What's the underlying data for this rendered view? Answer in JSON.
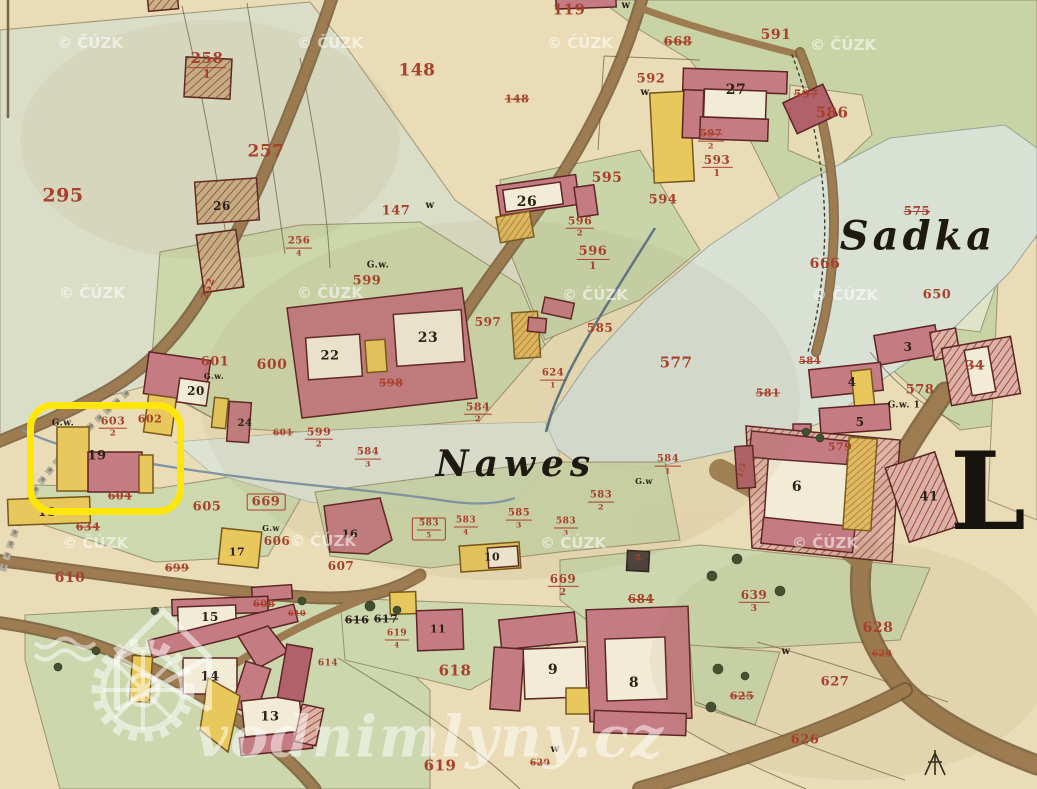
{
  "map": {
    "big_letter": "L",
    "logo_text": "vodnimlyny.cz",
    "palette": {
      "label_red": "#a8402c",
      "label_black": "#2b2217",
      "highlight_yellow": "#ffe60a",
      "building_pink": "#c47c82",
      "building_yellow": "#e8c85c",
      "road_brown": "#9c7c50",
      "field_green": "#c9d4a6",
      "pond_grey": "#d9e1d5",
      "paper": "#e9dcb6",
      "watermark_white": "rgba(255,255,255,0.55)"
    },
    "watermark": {
      "text": "© ČÚZK",
      "positions": [
        [
          90,
          43
        ],
        [
          330,
          43
        ],
        [
          580,
          43
        ],
        [
          843,
          45
        ],
        [
          92,
          293
        ],
        [
          330,
          293
        ],
        [
          595,
          295
        ],
        [
          845,
          295
        ],
        [
          95,
          543
        ],
        [
          323,
          541
        ],
        [
          573,
          543
        ],
        [
          825,
          543
        ]
      ]
    },
    "highlight": {
      "x": 27,
      "y": 402,
      "w": 143,
      "h": 99,
      "radius": 26,
      "color": "#ffe60a",
      "thickness": 7
    },
    "place_names": [
      {
        "text": "Sadka",
        "x": 918,
        "y": 236,
        "size": 40,
        "ls": 4
      },
      {
        "text": "Nawes",
        "x": 516,
        "y": 464,
        "size": 36,
        "ls": 6
      }
    ],
    "labels": [
      {
        "t": "295",
        "x": 63,
        "y": 196,
        "c": "r",
        "s": 19
      },
      {
        "t": "258",
        "d": "1",
        "x": 207,
        "y": 66,
        "c": "r",
        "s": 15
      },
      {
        "t": "257",
        "x": 266,
        "y": 152,
        "c": "r",
        "s": 17
      },
      {
        "t": "256",
        "d": "4",
        "x": 299,
        "y": 247,
        "c": "r",
        "s": 10
      },
      {
        "t": "252",
        "x": 209,
        "y": 289,
        "c": "r",
        "s": 10,
        "o": -70
      },
      {
        "t": "26",
        "x": 222,
        "y": 206,
        "c": "k",
        "s": 12
      },
      {
        "t": "119",
        "x": 569,
        "y": 10,
        "c": "r",
        "s": 15
      },
      {
        "t": "148",
        "x": 417,
        "y": 71,
        "c": "r",
        "s": 17
      },
      {
        "t": "148",
        "x": 517,
        "y": 99,
        "c": "r",
        "s": 11,
        "st": true
      },
      {
        "t": "147",
        "x": 396,
        "y": 211,
        "c": "r",
        "s": 13
      },
      {
        "t": "w",
        "x": 430,
        "y": 206,
        "c": "k",
        "s": 10
      },
      {
        "t": "w",
        "x": 626,
        "y": 6,
        "c": "k",
        "s": 10
      },
      {
        "t": "591",
        "x": 776,
        "y": 35,
        "c": "r",
        "s": 14
      },
      {
        "t": "592",
        "x": 651,
        "y": 79,
        "c": "r",
        "s": 13
      },
      {
        "t": "w",
        "x": 645,
        "y": 93,
        "c": "k",
        "s": 10
      },
      {
        "t": "668",
        "x": 678,
        "y": 42,
        "c": "r",
        "s": 13,
        "st": true
      },
      {
        "t": "27",
        "x": 736,
        "y": 90,
        "c": "k",
        "s": 14
      },
      {
        "t": "597",
        "x": 806,
        "y": 94,
        "c": "r",
        "s": 11,
        "st": true
      },
      {
        "t": "586",
        "x": 832,
        "y": 113,
        "c": "r",
        "s": 15
      },
      {
        "t": "597",
        "d": "2",
        "x": 711,
        "y": 140,
        "c": "r",
        "s": 10,
        "st": true
      },
      {
        "t": "593",
        "d": "1",
        "x": 717,
        "y": 166,
        "c": "r",
        "s": 12
      },
      {
        "t": "595",
        "x": 607,
        "y": 178,
        "c": "r",
        "s": 14
      },
      {
        "t": "594",
        "x": 663,
        "y": 200,
        "c": "r",
        "s": 13
      },
      {
        "t": "26",
        "x": 527,
        "y": 202,
        "c": "k",
        "s": 14
      },
      {
        "t": "596",
        "d": "2",
        "x": 580,
        "y": 227,
        "c": "r",
        "s": 11
      },
      {
        "t": "596",
        "d": "1",
        "x": 593,
        "y": 258,
        "c": "r",
        "s": 13
      },
      {
        "t": "G.w.",
        "x": 378,
        "y": 266,
        "c": "k",
        "s": 9
      },
      {
        "t": "599",
        "x": 367,
        "y": 281,
        "c": "r",
        "s": 13
      },
      {
        "t": "598",
        "x": 391,
        "y": 383,
        "c": "r",
        "s": 11,
        "st": true
      },
      {
        "t": "22",
        "x": 330,
        "y": 356,
        "c": "k",
        "s": 13
      },
      {
        "t": "23",
        "x": 428,
        "y": 338,
        "c": "k",
        "s": 14
      },
      {
        "t": "600",
        "x": 272,
        "y": 365,
        "c": "r",
        "s": 14
      },
      {
        "t": "601",
        "x": 215,
        "y": 362,
        "c": "r",
        "s": 13
      },
      {
        "t": "G.w.",
        "x": 214,
        "y": 376,
        "c": "k",
        "s": 8
      },
      {
        "t": "20",
        "x": 196,
        "y": 391,
        "c": "k",
        "s": 12
      },
      {
        "t": "24",
        "x": 245,
        "y": 424,
        "c": "k",
        "s": 10
      },
      {
        "t": "601",
        "x": 283,
        "y": 434,
        "c": "r",
        "s": 9,
        "st": true
      },
      {
        "t": "599",
        "d": "2",
        "x": 319,
        "y": 438,
        "c": "r",
        "s": 11
      },
      {
        "t": "584",
        "d": "3",
        "x": 368,
        "y": 458,
        "c": "r",
        "s": 10
      },
      {
        "t": "597",
        "x": 488,
        "y": 322,
        "c": "r",
        "s": 12
      },
      {
        "t": "585",
        "x": 600,
        "y": 328,
        "c": "r",
        "s": 12
      },
      {
        "t": "577",
        "x": 676,
        "y": 363,
        "c": "r",
        "s": 15
      },
      {
        "t": "575",
        "x": 917,
        "y": 211,
        "c": "r",
        "s": 12,
        "st": true
      },
      {
        "t": "666",
        "x": 825,
        "y": 264,
        "c": "r",
        "s": 14
      },
      {
        "t": "650",
        "x": 937,
        "y": 295,
        "c": "r",
        "s": 13
      },
      {
        "t": "584",
        "x": 810,
        "y": 362,
        "c": "r",
        "s": 10,
        "st": true
      },
      {
        "t": "581",
        "x": 768,
        "y": 393,
        "c": "r",
        "s": 11,
        "st": true
      },
      {
        "t": "3",
        "x": 908,
        "y": 347,
        "c": "k",
        "s": 12
      },
      {
        "t": "34",
        "x": 975,
        "y": 366,
        "c": "r",
        "s": 13,
        "st": true
      },
      {
        "t": "4",
        "x": 852,
        "y": 382,
        "c": "k",
        "s": 12
      },
      {
        "t": "5",
        "x": 860,
        "y": 422,
        "c": "k",
        "s": 12
      },
      {
        "t": "578",
        "x": 920,
        "y": 390,
        "c": "r",
        "s": 13
      },
      {
        "t": "G.w. 1",
        "x": 904,
        "y": 406,
        "c": "k",
        "s": 9
      },
      {
        "t": "579",
        "x": 840,
        "y": 447,
        "c": "r",
        "s": 11
      },
      {
        "t": "41",
        "x": 929,
        "y": 497,
        "c": "k",
        "s": 13
      },
      {
        "t": "6",
        "x": 797,
        "y": 487,
        "c": "k",
        "s": 14
      },
      {
        "t": "1/3",
        "x": 741,
        "y": 470,
        "c": "r",
        "s": 8,
        "o": -75
      },
      {
        "t": "584",
        "d": "2",
        "x": 478,
        "y": 413,
        "c": "r",
        "s": 11
      },
      {
        "t": "624",
        "d": "1",
        "x": 553,
        "y": 379,
        "c": "r",
        "s": 10
      },
      {
        "t": "584",
        "d": "1",
        "x": 668,
        "y": 465,
        "c": "r",
        "s": 10
      },
      {
        "t": "G.w",
        "x": 644,
        "y": 481,
        "c": "k",
        "s": 8
      },
      {
        "t": "583",
        "d": "2",
        "x": 601,
        "y": 501,
        "c": "r",
        "s": 10
      },
      {
        "t": "583",
        "d": "3",
        "x": 566,
        "y": 527,
        "c": "r",
        "s": 9
      },
      {
        "t": "585",
        "d": "3",
        "x": 519,
        "y": 519,
        "c": "r",
        "s": 10
      },
      {
        "t": "583",
        "d": "4",
        "x": 466,
        "y": 526,
        "c": "r",
        "s": 9
      },
      {
        "t": "583",
        "d": "5",
        "x": 429,
        "y": 529,
        "c": "r",
        "s": 9,
        "bx": true
      },
      {
        "t": "10",
        "x": 492,
        "y": 557,
        "c": "k",
        "s": 11
      },
      {
        "t": "G.w.",
        "x": 63,
        "y": 424,
        "c": "k",
        "s": 9
      },
      {
        "t": "603",
        "d": "2",
        "x": 113,
        "y": 427,
        "c": "r",
        "s": 11
      },
      {
        "t": "602",
        "x": 150,
        "y": 419,
        "c": "r",
        "s": 11
      },
      {
        "t": "19",
        "x": 97,
        "y": 456,
        "c": "k",
        "s": 13
      },
      {
        "t": "18",
        "x": 47,
        "y": 512,
        "c": "k",
        "s": 12
      },
      {
        "t": "634",
        "x": 88,
        "y": 527,
        "c": "r",
        "s": 11,
        "st": true
      },
      {
        "t": "604",
        "x": 120,
        "y": 496,
        "c": "r",
        "s": 11,
        "st": true
      },
      {
        "t": "605",
        "x": 207,
        "y": 507,
        "c": "r",
        "s": 13
      },
      {
        "t": "669",
        "x": 266,
        "y": 502,
        "c": "r",
        "s": 13,
        "bx": true
      },
      {
        "t": "G.w",
        "x": 271,
        "y": 528,
        "c": "k",
        "s": 8
      },
      {
        "t": "606",
        "x": 277,
        "y": 541,
        "c": "r",
        "s": 12
      },
      {
        "t": "17",
        "x": 237,
        "y": 552,
        "c": "k",
        "s": 11
      },
      {
        "t": "16",
        "x": 350,
        "y": 534,
        "c": "k",
        "s": 11
      },
      {
        "t": "699",
        "x": 177,
        "y": 568,
        "c": "r",
        "s": 11,
        "st": true
      },
      {
        "t": "607",
        "x": 341,
        "y": 566,
        "c": "r",
        "s": 12
      },
      {
        "t": "610",
        "x": 70,
        "y": 578,
        "c": "r",
        "s": 14
      },
      {
        "t": "608",
        "x": 264,
        "y": 605,
        "c": "r",
        "s": 10,
        "st": true
      },
      {
        "t": "610",
        "x": 297,
        "y": 613,
        "c": "r",
        "s": 8,
        "st": true
      },
      {
        "t": "15",
        "x": 210,
        "y": 617,
        "c": "k",
        "s": 12
      },
      {
        "t": "14",
        "x": 210,
        "y": 677,
        "c": "k",
        "s": 13
      },
      {
        "t": "13",
        "x": 270,
        "y": 717,
        "c": "k",
        "s": 13
      },
      {
        "t": "614",
        "x": 328,
        "y": 664,
        "c": "r",
        "s": 9
      },
      {
        "t": "616",
        "x": 357,
        "y": 620,
        "c": "k",
        "s": 11,
        "st": true
      },
      {
        "t": "617",
        "x": 386,
        "y": 619,
        "c": "k",
        "s": 11,
        "st": true
      },
      {
        "t": "619",
        "d": "4",
        "x": 397,
        "y": 639,
        "c": "r",
        "s": 9
      },
      {
        "t": "11",
        "x": 438,
        "y": 629,
        "c": "k",
        "s": 11
      },
      {
        "t": "618",
        "x": 455,
        "y": 671,
        "c": "r",
        "s": 15
      },
      {
        "t": "9",
        "x": 553,
        "y": 670,
        "c": "k",
        "s": 14
      },
      {
        "t": "8",
        "x": 634,
        "y": 683,
        "c": "k",
        "s": 14
      },
      {
        "t": "619",
        "x": 440,
        "y": 766,
        "c": "r",
        "s": 15
      },
      {
        "t": "669",
        "d": "2",
        "x": 563,
        "y": 585,
        "c": "r",
        "s": 12
      },
      {
        "t": "684",
        "x": 641,
        "y": 599,
        "c": "r",
        "s": 12,
        "st": true
      },
      {
        "t": "639",
        "d": "3",
        "x": 754,
        "y": 601,
        "c": "r",
        "s": 12
      },
      {
        "t": "628",
        "x": 878,
        "y": 628,
        "c": "r",
        "s": 14
      },
      {
        "t": "629",
        "x": 882,
        "y": 655,
        "c": "r",
        "s": 9,
        "st": true
      },
      {
        "t": "627",
        "x": 835,
        "y": 682,
        "c": "r",
        "s": 13
      },
      {
        "t": "626",
        "x": 805,
        "y": 740,
        "c": "r",
        "s": 13
      },
      {
        "t": "625",
        "x": 742,
        "y": 696,
        "c": "r",
        "s": 11,
        "st": true
      },
      {
        "t": "w",
        "x": 786,
        "y": 652,
        "c": "k",
        "s": 10
      },
      {
        "t": "w",
        "x": 555,
        "y": 750,
        "c": "k",
        "s": 10
      },
      {
        "t": "620",
        "x": 540,
        "y": 764,
        "c": "r",
        "s": 9,
        "st": true
      },
      {
        "t": "7",
        "x": 638,
        "y": 560,
        "c": "r",
        "s": 9,
        "st": true
      }
    ]
  }
}
